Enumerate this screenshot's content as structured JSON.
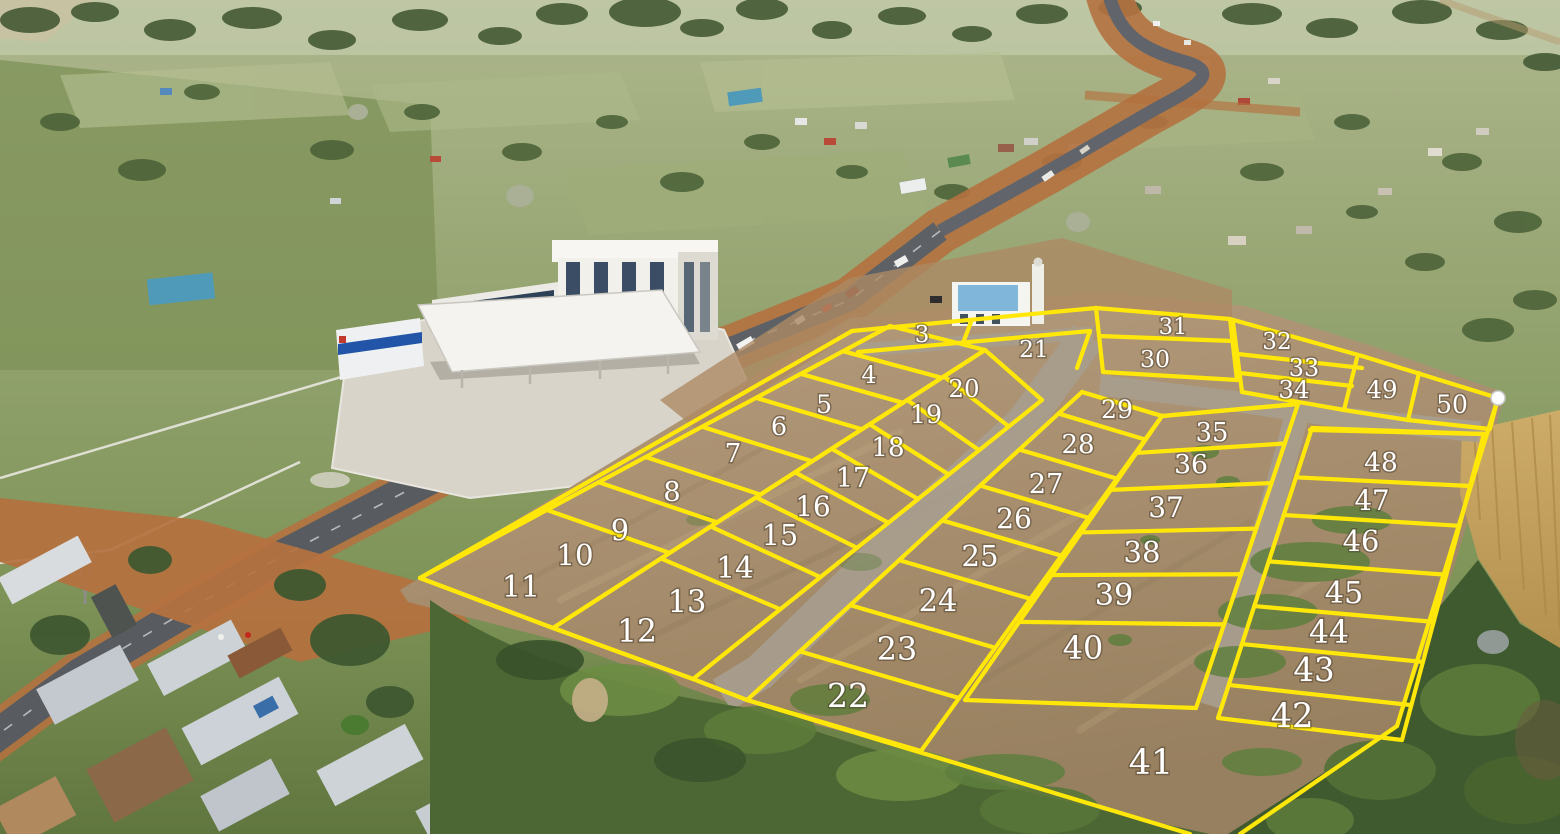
{
  "map": {
    "region_label": "Aerial drone photo of surveyed land plots beside a highway with numbered parcels marked in yellow",
    "boundary_color": "#ffe70a",
    "label_color": "#ffffff",
    "marker": {
      "x": 1498,
      "y": 398,
      "color": "#ffffff"
    },
    "plots": [
      {
        "n": "3",
        "x": 922,
        "y": 333
      },
      {
        "n": "4",
        "x": 869,
        "y": 374
      },
      {
        "n": "5",
        "x": 824,
        "y": 404
      },
      {
        "n": "6",
        "x": 779,
        "y": 426
      },
      {
        "n": "7",
        "x": 733,
        "y": 453
      },
      {
        "n": "8",
        "x": 672,
        "y": 492
      },
      {
        "n": "9",
        "x": 620,
        "y": 531
      },
      {
        "n": "10",
        "x": 575,
        "y": 556
      },
      {
        "n": "11",
        "x": 521,
        "y": 588
      },
      {
        "n": "12",
        "x": 637,
        "y": 633
      },
      {
        "n": "13",
        "x": 687,
        "y": 603
      },
      {
        "n": "14",
        "x": 735,
        "y": 569
      },
      {
        "n": "15",
        "x": 780,
        "y": 536
      },
      {
        "n": "16",
        "x": 813,
        "y": 507
      },
      {
        "n": "17",
        "x": 853,
        "y": 478
      },
      {
        "n": "18",
        "x": 888,
        "y": 447
      },
      {
        "n": "19",
        "x": 926,
        "y": 414
      },
      {
        "n": "20",
        "x": 964,
        "y": 388
      },
      {
        "n": "21",
        "x": 1034,
        "y": 348
      },
      {
        "n": "22",
        "x": 848,
        "y": 698
      },
      {
        "n": "23",
        "x": 897,
        "y": 651
      },
      {
        "n": "24",
        "x": 938,
        "y": 602
      },
      {
        "n": "25",
        "x": 980,
        "y": 557
      },
      {
        "n": "26",
        "x": 1014,
        "y": 519
      },
      {
        "n": "27",
        "x": 1046,
        "y": 484
      },
      {
        "n": "28",
        "x": 1078,
        "y": 444
      },
      {
        "n": "29",
        "x": 1117,
        "y": 409
      },
      {
        "n": "30",
        "x": 1155,
        "y": 358
      },
      {
        "n": "31",
        "x": 1173,
        "y": 325
      },
      {
        "n": "32",
        "x": 1277,
        "y": 340
      },
      {
        "n": "33",
        "x": 1304,
        "y": 367
      },
      {
        "n": "34",
        "x": 1294,
        "y": 389
      },
      {
        "n": "35",
        "x": 1212,
        "y": 432
      },
      {
        "n": "36",
        "x": 1191,
        "y": 464
      },
      {
        "n": "37",
        "x": 1166,
        "y": 508
      },
      {
        "n": "38",
        "x": 1142,
        "y": 553
      },
      {
        "n": "39",
        "x": 1114,
        "y": 596
      },
      {
        "n": "40",
        "x": 1083,
        "y": 650
      },
      {
        "n": "41",
        "x": 1151,
        "y": 765
      },
      {
        "n": "42",
        "x": 1292,
        "y": 718
      },
      {
        "n": "43",
        "x": 1314,
        "y": 672
      },
      {
        "n": "44",
        "x": 1329,
        "y": 634
      },
      {
        "n": "45",
        "x": 1344,
        "y": 594
      },
      {
        "n": "46",
        "x": 1361,
        "y": 542
      },
      {
        "n": "47",
        "x": 1372,
        "y": 501
      },
      {
        "n": "48",
        "x": 1381,
        "y": 462
      },
      {
        "n": "49",
        "x": 1382,
        "y": 389
      },
      {
        "n": "50",
        "x": 1452,
        "y": 404
      }
    ],
    "blocks": [
      {
        "front": [
          420,
          578,
          890,
          326
        ],
        "back": [
          553,
          628,
          985,
          350
        ],
        "cuts": [
          0,
          0.27,
          0.38,
          0.48,
          0.6,
          0.715,
          0.81,
          0.9,
          1
        ]
      },
      {
        "front": [
          553,
          628,
          985,
          350
        ],
        "back": [
          693,
          679,
          1042,
          400
        ],
        "cuts": [
          0,
          0.25,
          0.365,
          0.47,
          0.56,
          0.645,
          0.733,
          0.82,
          0.905,
          1
        ]
      },
      {
        "front": [
          747,
          700,
          1082,
          392
        ],
        "back": [
          921,
          751,
          1162,
          416
        ],
        "cuts": [
          0,
          0.158,
          0.308,
          0.454,
          0.583,
          0.696,
          0.813,
          0.93,
          1
        ]
      },
      {
        "front": [
          965,
          700,
          1162,
          416
        ],
        "back": [
          1196,
          708,
          1298,
          404
        ],
        "cuts": [
          0,
          0.275,
          0.44,
          0.59,
          0.74,
          0.87,
          1
        ]
      },
      {
        "front": [
          1218,
          718,
          1312,
          428
        ],
        "back": [
          1402,
          740,
          1484,
          434
        ],
        "cuts": [
          0,
          0.114,
          0.255,
          0.386,
          0.54,
          0.7,
          0.83,
          1
        ]
      }
    ],
    "segments": [
      [
        420,
        578,
        852,
        331
      ],
      [
        852,
        331,
        1096,
        308
      ],
      [
        1096,
        308,
        1230,
        319
      ],
      [
        1230,
        319,
        1362,
        356
      ],
      [
        1362,
        356,
        1498,
        398
      ],
      [
        1498,
        398,
        1397,
        726
      ],
      [
        1397,
        726,
        1240,
        834
      ],
      [
        420,
        578,
        553,
        628
      ],
      [
        553,
        628,
        693,
        679
      ],
      [
        693,
        679,
        747,
        700
      ],
      [
        747,
        700,
        1190,
        834
      ],
      [
        858,
        352,
        1090,
        331
      ],
      [
        963,
        343,
        971,
        322
      ],
      [
        1090,
        331,
        1077,
        368
      ],
      [
        1096,
        308,
        1103,
        372
      ],
      [
        1099,
        336,
        1233,
        341
      ],
      [
        1103,
        372,
        1237,
        380
      ],
      [
        1230,
        319,
        1237,
        380
      ],
      [
        1233,
        322,
        1242,
        392
      ],
      [
        1238,
        354,
        1362,
        368
      ],
      [
        1240,
        373,
        1352,
        386
      ],
      [
        1242,
        392,
        1344,
        410
      ],
      [
        1357,
        358,
        1344,
        410
      ],
      [
        1419,
        373,
        1408,
        420
      ],
      [
        1344,
        410,
        1408,
        420
      ],
      [
        1408,
        420,
        1490,
        429
      ],
      [
        1490,
        429,
        1498,
        398
      ],
      [
        1310,
        430,
        1482,
        434
      ],
      [
        1082,
        392,
        1162,
        416
      ],
      [
        1162,
        416,
        1298,
        404
      ]
    ]
  }
}
